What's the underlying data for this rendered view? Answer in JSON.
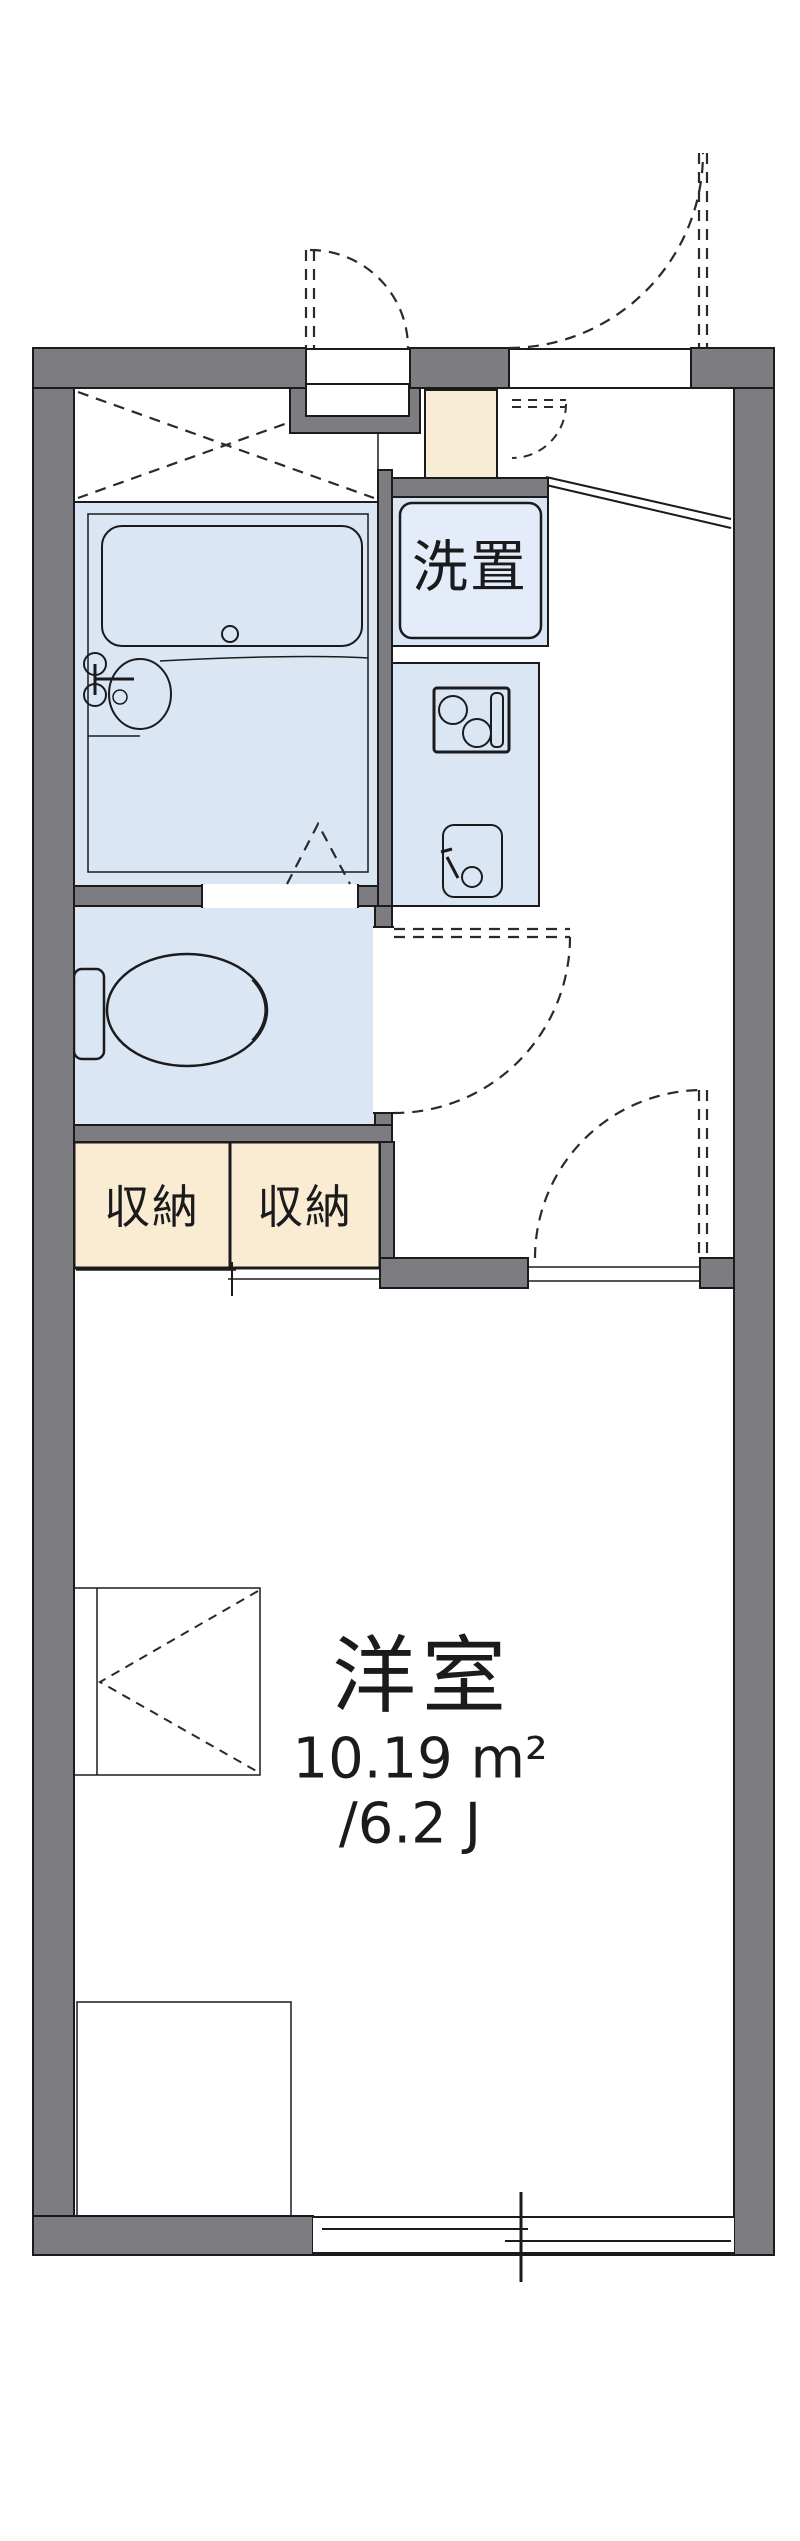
{
  "plan": {
    "type": "apartment-floor-plan",
    "labels": {
      "laundry": "洗置",
      "storage_left": "収納",
      "storage_right": "収納",
      "main_room_name": "洋室",
      "main_room_area_m2": "10.19 m²",
      "main_room_area_jo": "/6.2 J"
    },
    "rooms": [
      {
        "name": "bathroom",
        "fill": "water"
      },
      {
        "name": "toilet",
        "fill": "water"
      },
      {
        "name": "kitchen-counter",
        "fill": "water"
      },
      {
        "name": "laundry-space",
        "label": "洗置",
        "fill": "water"
      },
      {
        "name": "storage-left",
        "label": "収納",
        "fill": "storage"
      },
      {
        "name": "storage-right",
        "label": "収納",
        "fill": "storage"
      },
      {
        "name": "entrance-genkan",
        "fill": "genkan"
      },
      {
        "name": "western-room",
        "label": "洋室",
        "area_m2": "10.19 m²",
        "area_jo": "/6.2 J"
      }
    ],
    "colors": {
      "wall": "#7d7d81",
      "line": "#1b1b1d",
      "water": "#dbe6f5",
      "storage": "#faecd2",
      "genkan": "#f9ecd6"
    }
  }
}
